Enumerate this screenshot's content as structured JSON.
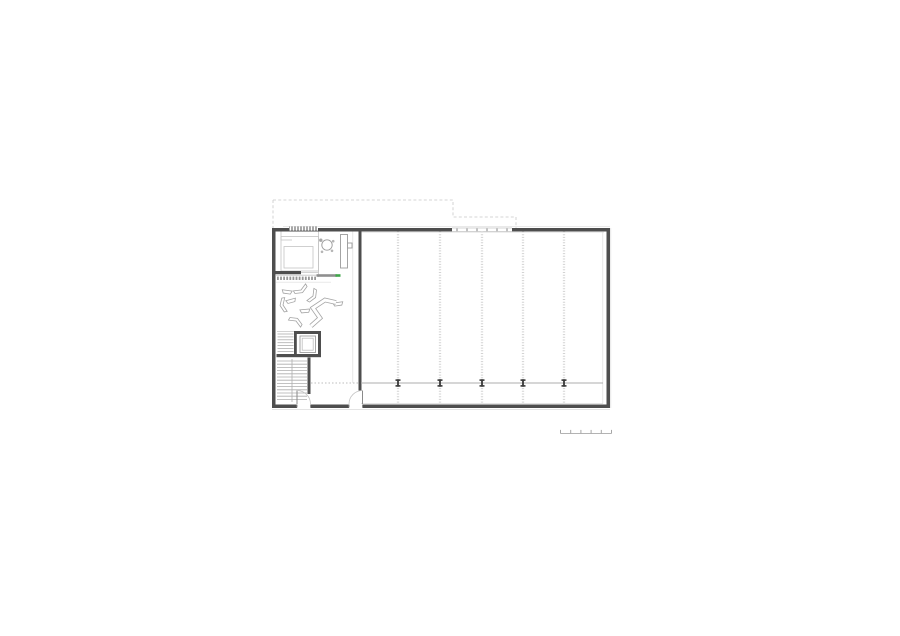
{
  "drawing": {
    "type": "architectural-floor-plan",
    "description": "ground floor plan of a rectangular hall building with entry lobby, lounge furniture, elevator core, two staircases and a five-bay hall",
    "background": "#ffffff"
  },
  "colors": {
    "wall_dark": "#4e4e4e",
    "column_dark": "#3a3a3a",
    "line_medium": "#9b9b9b",
    "line_light": "#c4c4c4",
    "line_xlight": "#dcdcdc",
    "dotted_grid": "#d3d3d3",
    "hatch_gray": "#979797",
    "accent_green": "#3fa64a"
  },
  "plan": {
    "outline": {
      "x1": 272,
      "y1": 228,
      "x2": 610,
      "y2": 408,
      "wall_thickness": 3.5
    },
    "canopy": {
      "points": [
        [
          273,
          200
        ],
        [
          453,
          200
        ],
        [
          453,
          217
        ],
        [
          516,
          217
        ],
        [
          516,
          228
        ]
      ],
      "left_drop": [
        [
          273,
          200
        ],
        [
          273,
          228
        ]
      ]
    },
    "hall": {
      "bay_line_xs": [
        398,
        440,
        482,
        523,
        564
      ],
      "bay_top": 231.5,
      "bay_bottom": 404,
      "facade_line_y": 383,
      "facade_solid_x1": 361,
      "facade_solid_x2": 603,
      "facade_dot_x1": 311,
      "facade_dot_x2": 358,
      "column_xs": [
        398,
        440,
        482,
        523,
        564
      ],
      "column_w": 5,
      "column_h": 7.4
    },
    "window_band": {
      "x1": 452,
      "x2": 512,
      "y": 227.6,
      "h": 4.4,
      "tick_xs": [
        457,
        467,
        477,
        487,
        497,
        507
      ]
    },
    "entrance_mat": {
      "x1": 289,
      "x2": 318,
      "y": 226.4,
      "h": 4.2,
      "tick_step": 3
    },
    "coat_rack": {
      "hatch_x1": 277,
      "hatch_x2": 316,
      "hatch_y": 276.6,
      "tick_step": 3.1,
      "bar": {
        "x": 316.5,
        "y": 274.2,
        "w": 20,
        "h": 2.6
      },
      "green_tip": {
        "x": 335.5,
        "y": 274.2,
        "w": 5,
        "h": 2.6
      }
    },
    "doors": [
      {
        "hinge_x": 297,
        "hinge_y": 404,
        "radius": 13.5,
        "sweep": "cw"
      },
      {
        "hinge_x": 362.5,
        "hinge_y": 404,
        "radius": 13.5,
        "sweep": "ccw"
      }
    ],
    "stairs": [
      {
        "name": "service-stair",
        "x1": 277.5,
        "x2": 293.5,
        "y_start": 334,
        "step": 2.9,
        "count": 7
      },
      {
        "name": "main-stair",
        "x1": 277,
        "x2": 307,
        "y_start": 361,
        "step": 3.2,
        "count": 13
      }
    ],
    "lounge_items": [
      {
        "type": "chevron",
        "x": 301,
        "y": 290,
        "rot": -30
      },
      {
        "type": "seat",
        "x": 287,
        "y": 292,
        "rot": 8
      },
      {
        "type": "chevron",
        "x": 283,
        "y": 305,
        "rot": 80
      },
      {
        "type": "seat",
        "x": 291,
        "y": 301,
        "rot": -15
      },
      {
        "type": "seat",
        "x": 305,
        "y": 311,
        "rot": -5
      },
      {
        "type": "chevron",
        "x": 296,
        "y": 321,
        "rot": 210
      },
      {
        "type": "seat",
        "x": 338,
        "y": 304,
        "rot": -8
      },
      {
        "type": "chevron",
        "x": 313,
        "y": 296,
        "rot": -60
      }
    ],
    "bench_path": [
      [
        311,
        326
      ],
      [
        320,
        318
      ],
      [
        313,
        308
      ],
      [
        325,
        300
      ],
      [
        336,
        302.5
      ]
    ],
    "scale_bar": {
      "x": 560.5,
      "y": 433.5,
      "segment_px": 10.2,
      "segments": 5,
      "tick_h": 3.6
    }
  }
}
